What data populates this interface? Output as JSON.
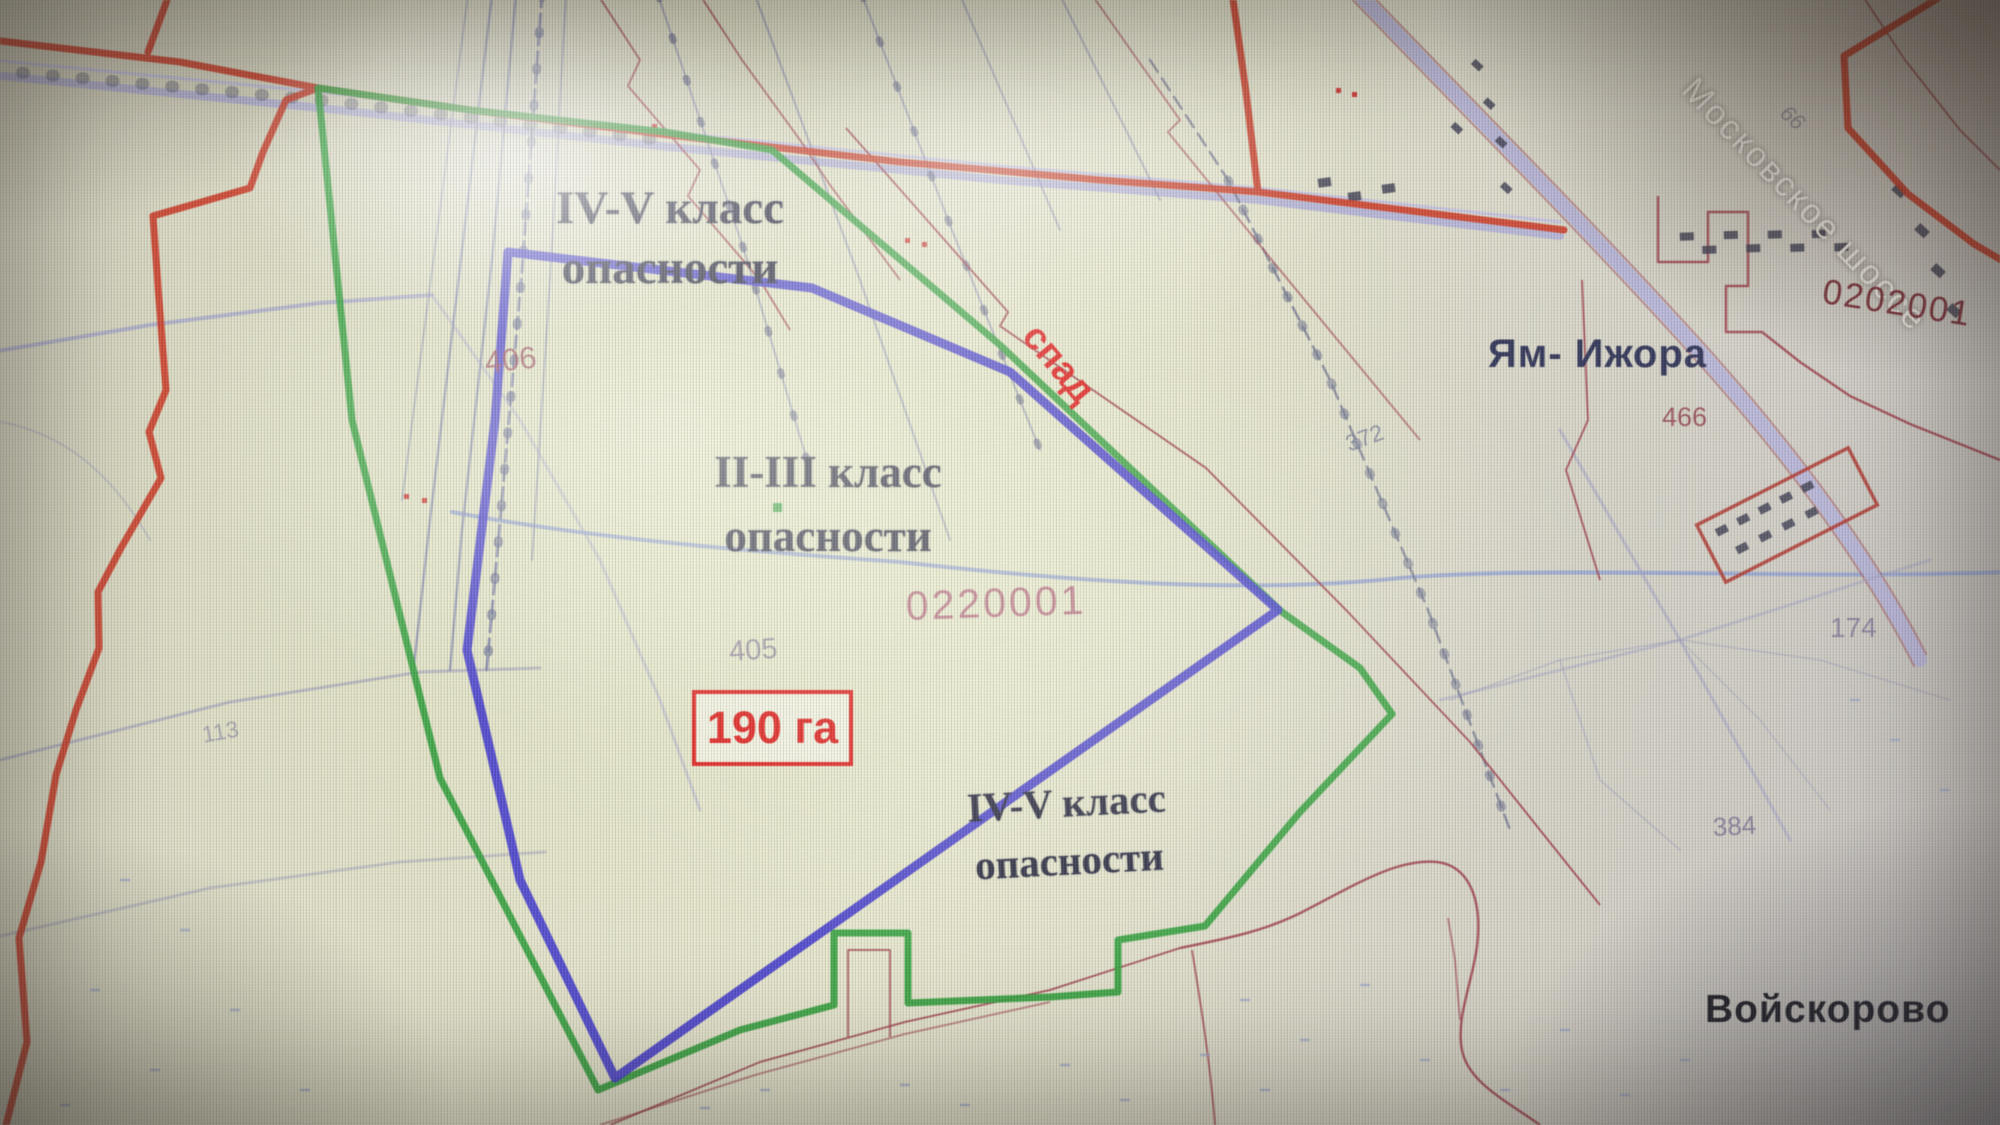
{
  "map": {
    "hazard_zones": {
      "north": {
        "line1": "IV-V класс",
        "line2": "опасности"
      },
      "central": {
        "line1": "II-III класс",
        "line2": "опасности"
      },
      "south": {
        "line1": "IV-V класс",
        "line2": "опасности"
      }
    },
    "area_box": {
      "value": "190 га"
    },
    "slope_note": "спад",
    "road_label": "Московское шоссе",
    "settlements": {
      "yam_izhora": "Ям- Ижора",
      "voyskorovo": "Войскорово"
    },
    "cadastral_quarter_numbers": {
      "left": "0220001",
      "right": "0202001"
    },
    "parcel_numbers": {
      "p406": "406",
      "p405": "405",
      "p466": "466",
      "p372": "372",
      "p174": "174",
      "p384": "384",
      "p113": "113",
      "p66": "66"
    },
    "colors": {
      "municipal_boundary_red": "#cd3a26",
      "sanitary_zone_green": "#2ea03a",
      "site_boundary_blue": "#423ad0",
      "area_text_red": "#e01414"
    }
  }
}
